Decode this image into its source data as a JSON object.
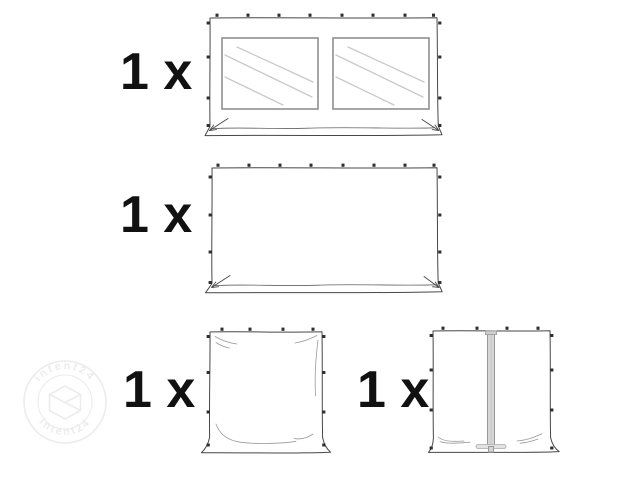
{
  "items": [
    {
      "count_label": "1 x",
      "illustration": "sidewall-with-two-windows"
    },
    {
      "count_label": "1 x",
      "illustration": "plain-full-sidewall"
    },
    {
      "count_label": "1 x",
      "illustration": "plain-half-sidewall"
    },
    {
      "count_label": "1 x",
      "illustration": "sidewall-with-zipper-door"
    }
  ],
  "watermark": {
    "text_top": "intent24",
    "text_bottom": "intent24"
  },
  "colors": {
    "ink": "#474747",
    "tick": "#2f2f2f",
    "label_ink": "#111111",
    "window_frame": "#8f8f8f",
    "window_glass_lines": "#c9c9c9",
    "zipper_fill": "#d6d6d6",
    "zipper_edge": "#999999",
    "watermark": "#ececec"
  }
}
